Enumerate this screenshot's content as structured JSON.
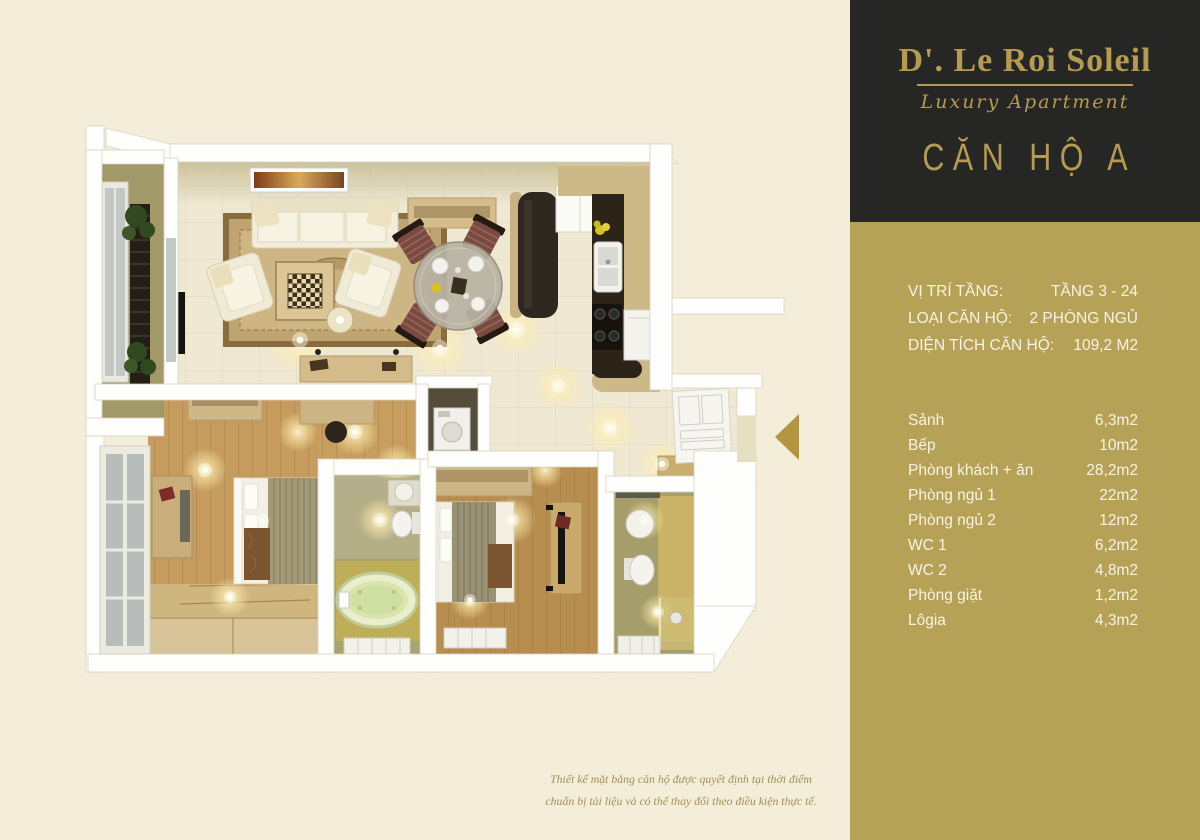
{
  "brand": {
    "name": "D'. Le Roi Soleil",
    "tagline": "Luxury Apartment",
    "unit": "CĂN HỘ A"
  },
  "apartment_info": {
    "rows": [
      {
        "label": "VỊ TRÍ TẦNG:",
        "value": "TẦNG 3 - 24"
      },
      {
        "label": "LOẠI CĂN HỘ:",
        "value": "2 PHÒNG NGỦ"
      },
      {
        "label": "DIỆN TÍCH CĂN HỘ:",
        "value": "109,2 M2"
      }
    ]
  },
  "room_areas": {
    "rows": [
      {
        "label": "Sảnh",
        "value": "6,3m2"
      },
      {
        "label": "Bếp",
        "value": "10m2"
      },
      {
        "label": "Phòng khách + ăn",
        "value": "28,2m2"
      },
      {
        "label": "Phòng ngủ 1",
        "value": "22m2"
      },
      {
        "label": "Phòng ngủ 2",
        "value": "12m2"
      },
      {
        "label": "WC 1",
        "value": "6,2m2"
      },
      {
        "label": "WC 2",
        "value": "4,8m2"
      },
      {
        "label": "Phòng giặt",
        "value": "1,2m2"
      },
      {
        "label": "Lôgia",
        "value": "4,3m2"
      }
    ]
  },
  "disclaimer": {
    "line1": "Thiết kế mặt bằng căn hộ được quyết định tại thời điểm",
    "line2": "chuẩn bị tài liệu và có thể thay đổi theo điều kiện thực tế."
  },
  "floor_plan": {
    "type": "3d-top-down-floor-plan",
    "entrance_arrow_direction": "left",
    "rooms_shown": [
      "living-dining room",
      "kitchen",
      "bedroom-1",
      "bedroom-2",
      "wc-1",
      "wc-2",
      "laundry",
      "hallway",
      "balcony"
    ]
  },
  "colors": {
    "page_cream": "#f3edda",
    "panel_dark": "#262624",
    "panel_gold": "#b6a257",
    "accent_gold": "#b59b52",
    "panel_text": "#f7f3e3",
    "disclaimer_gold": "#a2914e",
    "arrow_gold": "#b3953f"
  }
}
